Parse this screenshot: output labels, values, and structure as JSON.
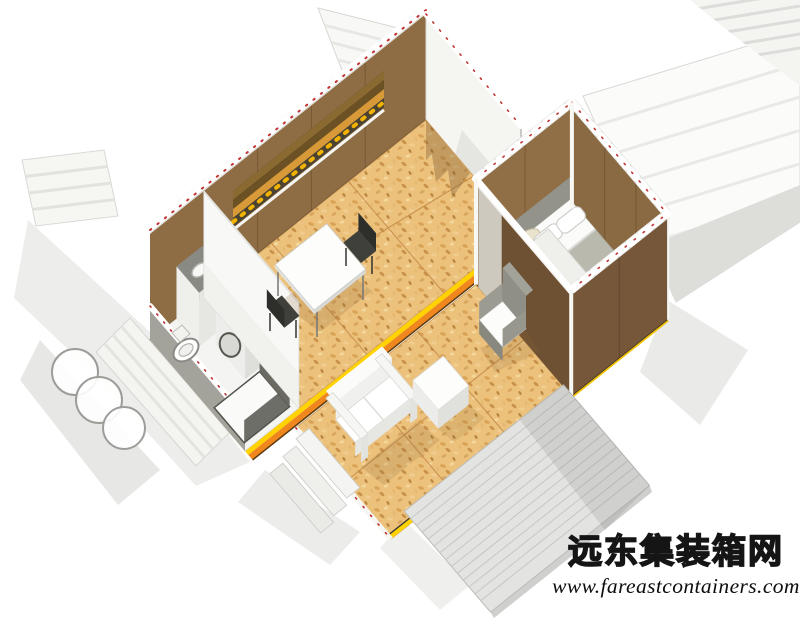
{
  "watermark": {
    "site_name": "远东集装箱网",
    "url": "www.fareastcontainers.com"
  },
  "scene": {
    "type": "isometric-3d-cutaway-rendering",
    "subject": "two-module shipping container house with exploded corrugated roof and wall panels and a wood deck",
    "rooms": [
      "bathroom",
      "kitchenette",
      "dining-area",
      "living-area",
      "bedroom",
      "wood-deck"
    ],
    "objects": [
      "dining-table",
      "dining-chairs",
      "counter-with-sink",
      "washing-machine",
      "toilet",
      "shower",
      "sofa",
      "coffee-table",
      "armchair",
      "double-bed",
      "pillows",
      "closet",
      "corrugated-panels",
      "entry-ramp-panels"
    ],
    "colors": {
      "background": "#ffffff",
      "osb_floor": "#ecc17b",
      "floor_seam": "#c68f4e",
      "wall_brown_light": "#8f6d44",
      "wall_brown_mid": "#8a6a42",
      "wall_brown_dark": "#77573a",
      "partition_brown": "#6e5132",
      "container_white": "#f5f5f2",
      "corrugation_gray": "#e2e2de",
      "cut_marker_red": "#c23232",
      "joint_yellow": "#ffd200",
      "joint_orange": "#f0861e",
      "shutter_amber": "#d89a38",
      "deck_gray": "#e3e3e1",
      "deck_plank_line": "#c6c6c4",
      "shadow_gray": "#ececea",
      "bedroom_floor_gray": "#a9a59b",
      "furniture_white": "#fcfcfc",
      "armchair_gray": "#8f8f87",
      "fixture_dark": "#55554f"
    }
  }
}
